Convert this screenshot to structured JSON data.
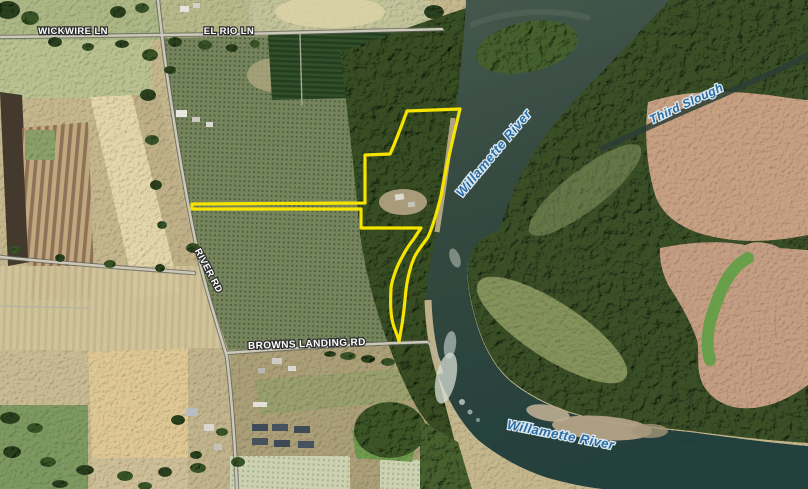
{
  "map": {
    "description": "Satellite map with highlighted property parcel along the Willamette River",
    "road_labels": [
      {
        "name": "wickwire-ln",
        "text": "WICKWIRE LN"
      },
      {
        "name": "el-rio-ln",
        "text": "EL RIO LN"
      },
      {
        "name": "river-rd",
        "text": "RIVER RD"
      },
      {
        "name": "browns-landing-rd",
        "text": "BROWNS LANDING RD"
      }
    ],
    "water_labels": [
      {
        "name": "willamette-river-upper",
        "text": "Willamette River"
      },
      {
        "name": "third-slough",
        "text": "Third Slough"
      },
      {
        "name": "willamette-river-lower",
        "text": "Willamette River"
      }
    ],
    "overlay": {
      "boundary_color": "#f6e400"
    },
    "colors": {
      "water_dark": "#24403c",
      "water_light": "#46584d",
      "forest": "#364e24",
      "orchard": "#76845c",
      "field_tan": "#cabb92",
      "field_pink_tan": "#c59f83",
      "road_label_fill": "#ffffff",
      "water_label_fill": "#2d6ca1"
    }
  }
}
